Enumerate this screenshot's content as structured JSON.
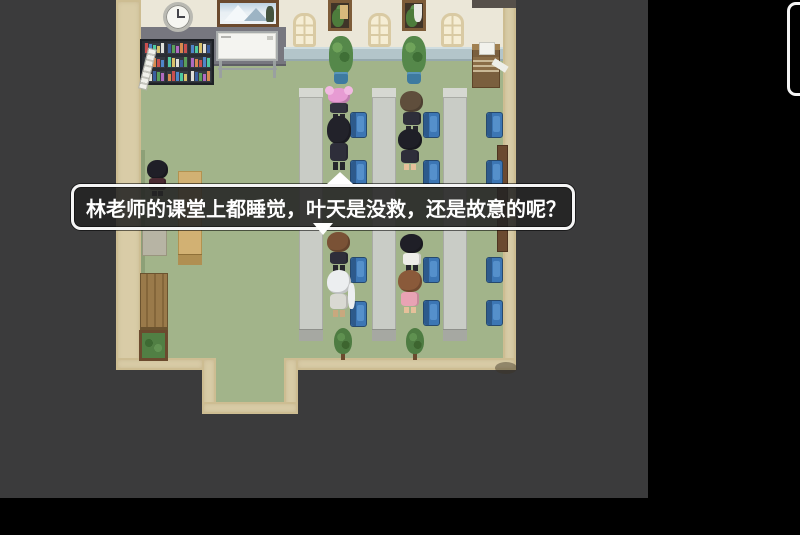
{
  "dialog": {
    "text": "林老师的课堂上都睡觉，叶天是没救，还是故意的呢？",
    "continue_indicator": "down-triangle",
    "speaker_indicator": "up-triangle"
  },
  "colors": {
    "letterbox": "#000000",
    "viewport_bg": "#3b3b3c",
    "floor": "#a2b48a",
    "wall_trim": "#d9cca7",
    "wall_upper": "#ebe7d8",
    "wainscot": "#b3c5ca",
    "chair_blue": "#3c76b4",
    "desk_gray": "#c9ccc6",
    "dialog_border": "#f5f5f5",
    "dialog_fill": "rgba(35,35,35,0.88)"
  },
  "scene": {
    "book_palette": [
      "#c94f4f",
      "#4f86c9",
      "#4fc9a0",
      "#d8c06a",
      "#e0e0da",
      "#3a5fa0",
      "#5aa05a",
      "#b06ac0",
      "#d88a4f"
    ],
    "desks": [
      {
        "x": 299,
        "y": 88,
        "w": 24,
        "h": 253
      },
      {
        "x": 372,
        "y": 88,
        "w": 24,
        "h": 253
      },
      {
        "x": 443,
        "y": 88,
        "w": 24,
        "h": 253
      }
    ],
    "chairs": [
      {
        "x": 350,
        "y": 112
      },
      {
        "x": 350,
        "y": 160
      },
      {
        "x": 350,
        "y": 257
      },
      {
        "x": 350,
        "y": 301
      },
      {
        "x": 423,
        "y": 112
      },
      {
        "x": 423,
        "y": 160
      },
      {
        "x": 423,
        "y": 257
      },
      {
        "x": 423,
        "y": 300
      },
      {
        "x": 486,
        "y": 112
      },
      {
        "x": 486,
        "y": 160
      },
      {
        "x": 486,
        "y": 257
      },
      {
        "x": 486,
        "y": 300
      }
    ],
    "plants_top": [
      {
        "x": 329,
        "y": 36
      },
      {
        "x": 402,
        "y": 36
      }
    ],
    "plants_bottom": [
      {
        "x": 332,
        "y": 328
      },
      {
        "x": 404,
        "y": 328
      }
    ],
    "characters": [
      {
        "id": "pink-hair-girl",
        "x": 327,
        "y": 88,
        "w": 24,
        "h": 30,
        "hair": "#e79bd3",
        "face": "#f6d8ba",
        "body": "#32323e",
        "extra": "buns",
        "accent": "#f2b9e2"
      },
      {
        "id": "buzz-cut-boy",
        "x": 399,
        "y": 91,
        "w": 25,
        "h": 41,
        "hair": "#5f4e3c",
        "face": "#f2d0ae",
        "body": "#2e2e3a"
      },
      {
        "id": "black-hair-boy",
        "x": 326,
        "y": 116,
        "w": 26,
        "h": 54,
        "hair": "#22222a",
        "body": "#2e2e3a"
      },
      {
        "id": "black-hair-girl",
        "x": 397,
        "y": 129,
        "w": 26,
        "h": 41,
        "hair": "#1f1f27",
        "body": "#2e2e3a",
        "legs": "#e6c09a"
      },
      {
        "id": "left-wall-student",
        "x": 146,
        "y": 160,
        "w": 23,
        "h": 36,
        "hair": "#1f1f27",
        "body": "#4a2a32"
      },
      {
        "id": "brown-hair-boy",
        "x": 326,
        "y": 232,
        "w": 25,
        "h": 39,
        "hair": "#7a5236",
        "face": "#f2d0ae",
        "body": "#2e2e3a"
      },
      {
        "id": "black-hair-girl-2",
        "x": 399,
        "y": 234,
        "w": 25,
        "h": 37,
        "hair": "#1f1f27",
        "body": "#eeeee8"
      },
      {
        "id": "white-hair-student",
        "x": 326,
        "y": 270,
        "w": 26,
        "h": 47,
        "hair": "#eceef0",
        "face": "#f2d0ae",
        "body": "#d9d9d2",
        "extra": "ponytail",
        "legs": "#c9a87e"
      },
      {
        "id": "pink-top-girl",
        "x": 397,
        "y": 270,
        "w": 26,
        "h": 43,
        "hair": "#8a5a3a",
        "face": "#f2d0ae",
        "body": "#e8a3b4",
        "legs": "#e6c09a"
      }
    ]
  }
}
